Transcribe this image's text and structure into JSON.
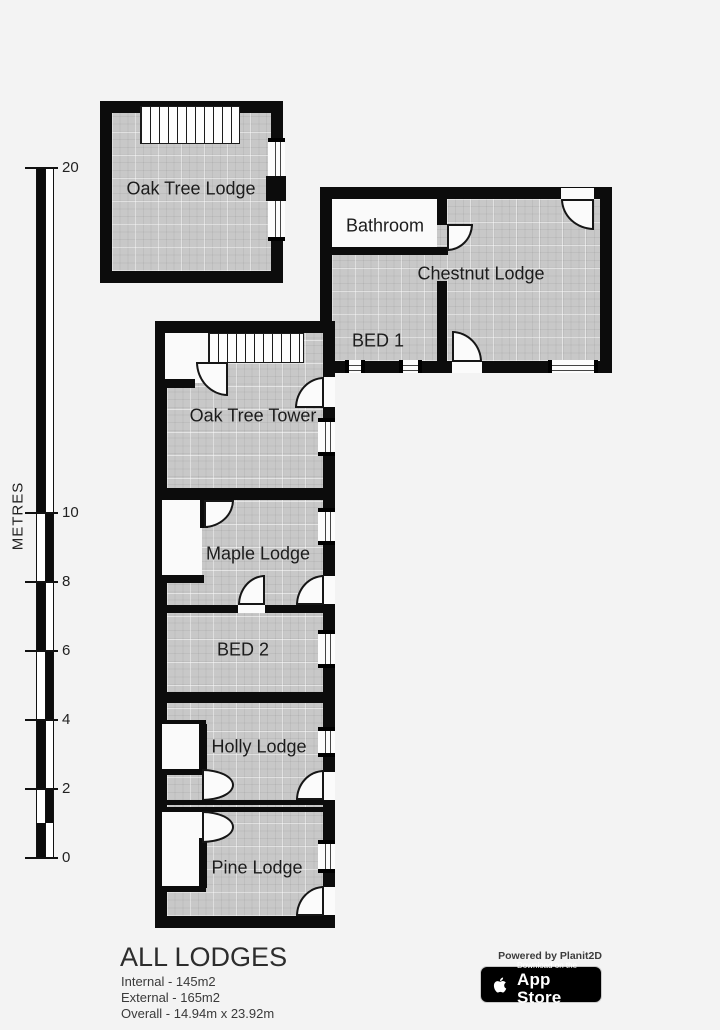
{
  "scale": {
    "unit_label": "METRES",
    "ticks": [
      "20",
      "10",
      "8",
      "6",
      "4",
      "2",
      "0"
    ]
  },
  "rooms": {
    "oak_tree_lodge": "Oak Tree Lodge",
    "bathroom": "Bathroom",
    "chestnut_lodge": "Chestnut Lodge",
    "bed1": "BED 1",
    "oak_tree_tower": "Oak Tree Tower",
    "maple_lodge": "Maple Lodge",
    "bed2": "BED 2",
    "holly_lodge": "Holly Lodge",
    "pine_lodge": "Pine Lodge"
  },
  "summary": {
    "title": "ALL LODGES",
    "internal": "Internal - 145m2",
    "external": "External - 165m2",
    "overall": "Overall - 14.94m x 23.92m"
  },
  "branding": {
    "powered_by": "Powered by Planit2D",
    "badge_tagline": "Download on the",
    "badge_title": "App Store"
  },
  "colors": {
    "wall": "#0c0c0c",
    "floor": "#c8c8c8",
    "background": "#f3f3f3"
  }
}
